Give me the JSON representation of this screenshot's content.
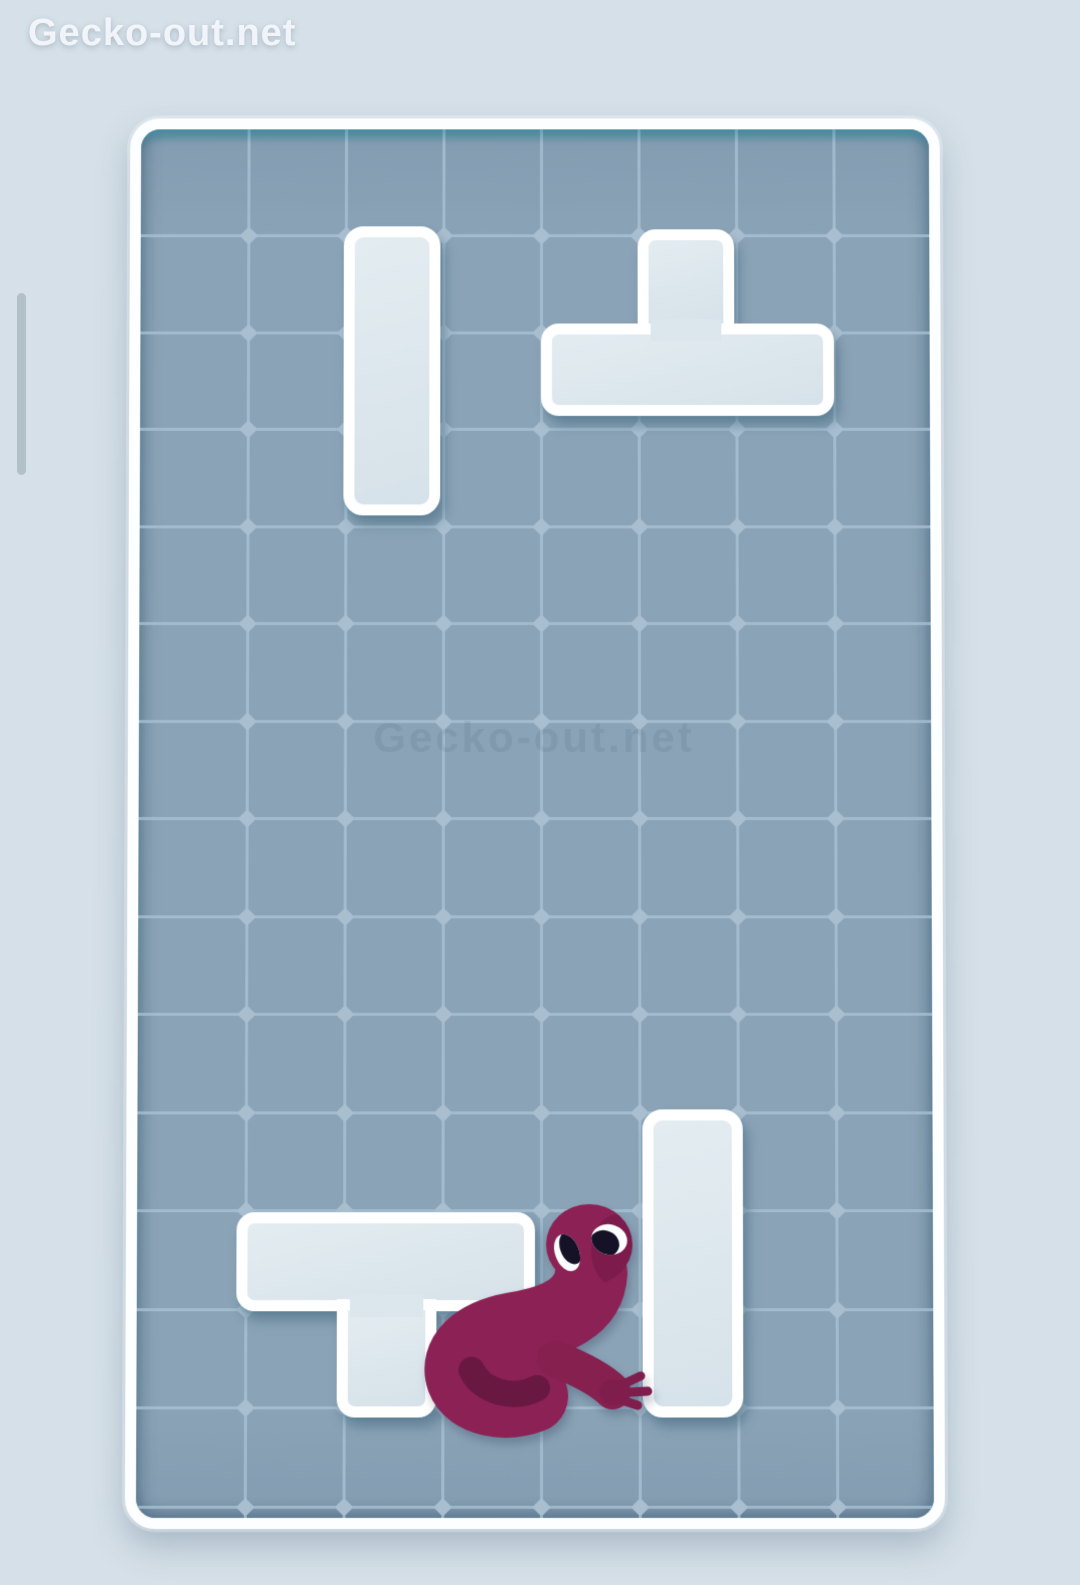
{
  "site": {
    "title": "Gecko-out.net"
  },
  "watermark": {
    "text": "Gecko-out.net"
  },
  "scrollbar": {
    "left": 17,
    "top": 293,
    "width": 9,
    "height": 182
  },
  "colors": {
    "page_background": "#d5e0e8",
    "board_fill": "#8ba3b7",
    "grid_line": "#aac3d6",
    "board_frame": "#fcfeff",
    "board_top_rim": "#4696aa",
    "hole_fill": "#dce7ed",
    "gecko_body": "#8c2155",
    "gecko_body_dark": "#7a1c4a",
    "gecko_toes": "#ea5f9d",
    "gecko_curl_shadow": "#151228",
    "gecko_eye_white": "#fbfdfe",
    "gecko_pupil": "#151126"
  },
  "board": {
    "left": 128,
    "top": 115,
    "width": 814,
    "height": 1408,
    "border": 11,
    "radius": 30,
    "inner_width": 792,
    "inner_height": 1386,
    "grid": {
      "v_lines": [
        108,
        206,
        304,
        402,
        500,
        598,
        696
      ],
      "h_lines": [
        107,
        205,
        302,
        400,
        497,
        595,
        692,
        790,
        887,
        985,
        1082,
        1180,
        1277,
        1375
      ],
      "columns": 8,
      "rows": 14
    }
  },
  "pieces": [
    {
      "id": "hole-i-vertical-top",
      "cells": "1x3 vertical, col 2 rows 1-3",
      "rects": [
        {
          "l": 204,
          "t": 98,
          "w": 97,
          "h": 291,
          "r": "20px"
        }
      ],
      "patches": []
    },
    {
      "id": "hole-t-top-right",
      "cells": "T-shape: stub col 5 row 1, bar cols 4-6 row 2",
      "rects": [
        {
          "l": 499,
          "t": 101,
          "w": 97,
          "h": 106,
          "r": "18px 18px 0 0"
        },
        {
          "l": 402,
          "t": 196,
          "w": 294,
          "h": 93,
          "r": "18px"
        }
      ],
      "patches": [
        {
          "l": 512,
          "t": 192,
          "w": 71,
          "h": 22
        }
      ]
    },
    {
      "id": "hole-i-vertical-bottom",
      "cells": "1x3 vertical, col 5 rows 10-12",
      "rects": [
        {
          "l": 503,
          "t": 982,
          "w": 100,
          "h": 305,
          "r": "20px"
        }
      ],
      "patches": []
    },
    {
      "id": "hole-t-bottom-left",
      "cells": "T-shape: bar cols 1-3 row 11, stub col 2 row 12",
      "rects": [
        {
          "l": 99,
          "t": 1084,
          "w": 297,
          "h": 98,
          "r": "18px"
        },
        {
          "l": 199,
          "t": 1170,
          "w": 99,
          "h": 117,
          "r": "0 0 18px 18px"
        }
      ],
      "patches": [
        {
          "l": 212,
          "t": 1166,
          "w": 73,
          "h": 22
        }
      ]
    }
  ]
}
